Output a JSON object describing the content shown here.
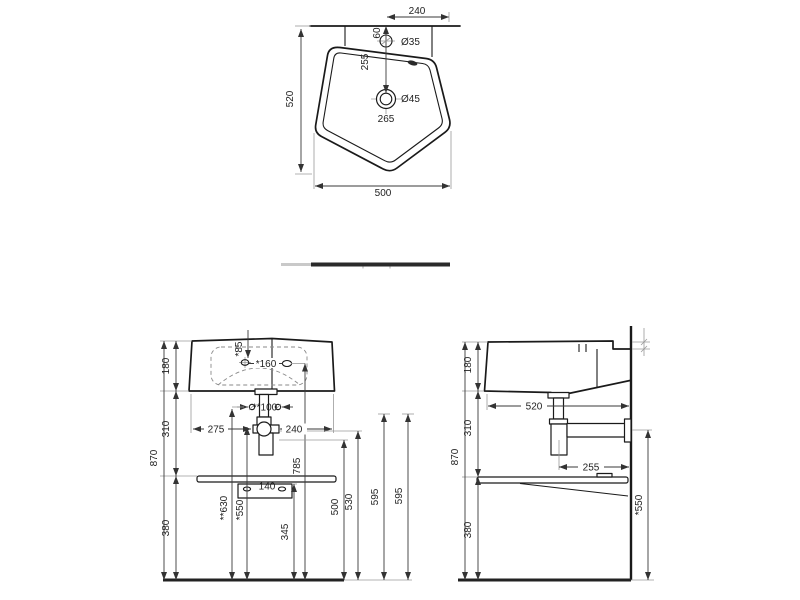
{
  "drawing": {
    "kind": "washbasin technical drawing",
    "colors": {
      "background": "#ffffff",
      "line": "#1a1a1a",
      "dimension": "#3a3a3a"
    },
    "top_view": {
      "dims": {
        "tap_to_edge": "240",
        "tap_offset": "60",
        "tap_hole_diameter": "Ø35",
        "wall_to_drain": "255",
        "drain_diameter": "Ø45",
        "drain_offset": "265",
        "overall_depth": "520",
        "overall_width": "500"
      }
    },
    "front_view": {
      "dims": {
        "basin_height": "180",
        "tap_hole_depth": "*85",
        "holes_spacing": "*160",
        "fixing_spacing": "**100",
        "edge_to_drain_left": "275",
        "drain_to_edge_right": "240",
        "mid_height": "310",
        "overall_height": "870",
        "hole_height": "785",
        "fixing_height": "**630",
        "trap_height": "*550",
        "bracket_height": "345",
        "outlet_height": "500",
        "outlet_height_2": "530",
        "ref_height_a": "595",
        "ref_height_b": "595",
        "shelf_height": "380",
        "bracket_slot_spacing": "140"
      }
    },
    "side_view": {
      "dims": {
        "basin_height": "180",
        "overall_depth": "520",
        "mid_height": "310",
        "overall_height": "870",
        "outlet_to_wall": "255",
        "outlet_height": "*550",
        "shelf_height": "380"
      }
    }
  }
}
